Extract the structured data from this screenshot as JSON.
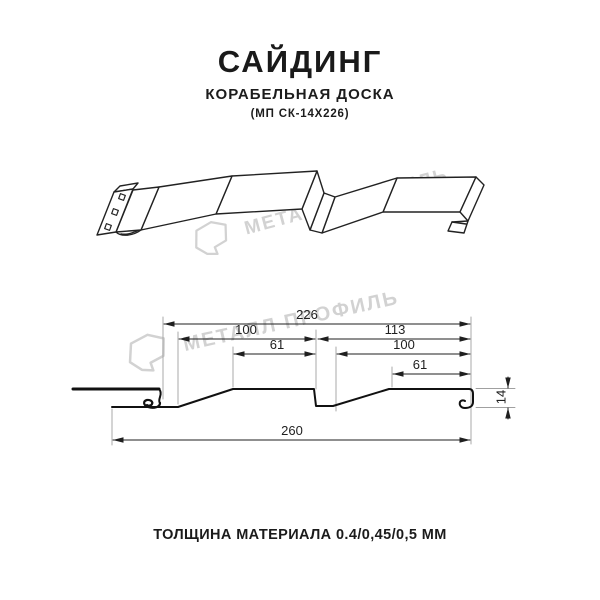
{
  "meta": {
    "background": "#ffffff",
    "ink_color": "#1a1a1a",
    "watermark_color": "#d2d2d2"
  },
  "header": {
    "title": "САЙДИНГ",
    "subtitle": "КОРАБЕЛЬНАЯ ДОСКА",
    "model_code": "(МП СК-14Х226)"
  },
  "watermark": {
    "brand": "МЕТАЛЛ ПРОФИЛЬ"
  },
  "section_view": {
    "dimensions": {
      "working_width": "226",
      "pitch_left": "100",
      "pitch_right": "113",
      "flat_left": "61",
      "inner_right": "100",
      "flat_right": "61",
      "overall_width": "260",
      "profile_height": "14"
    }
  },
  "footer": {
    "thickness_note": "ТОЛЩИНА МАТЕРИАЛА 0.4/0,45/0,5 ММ"
  }
}
